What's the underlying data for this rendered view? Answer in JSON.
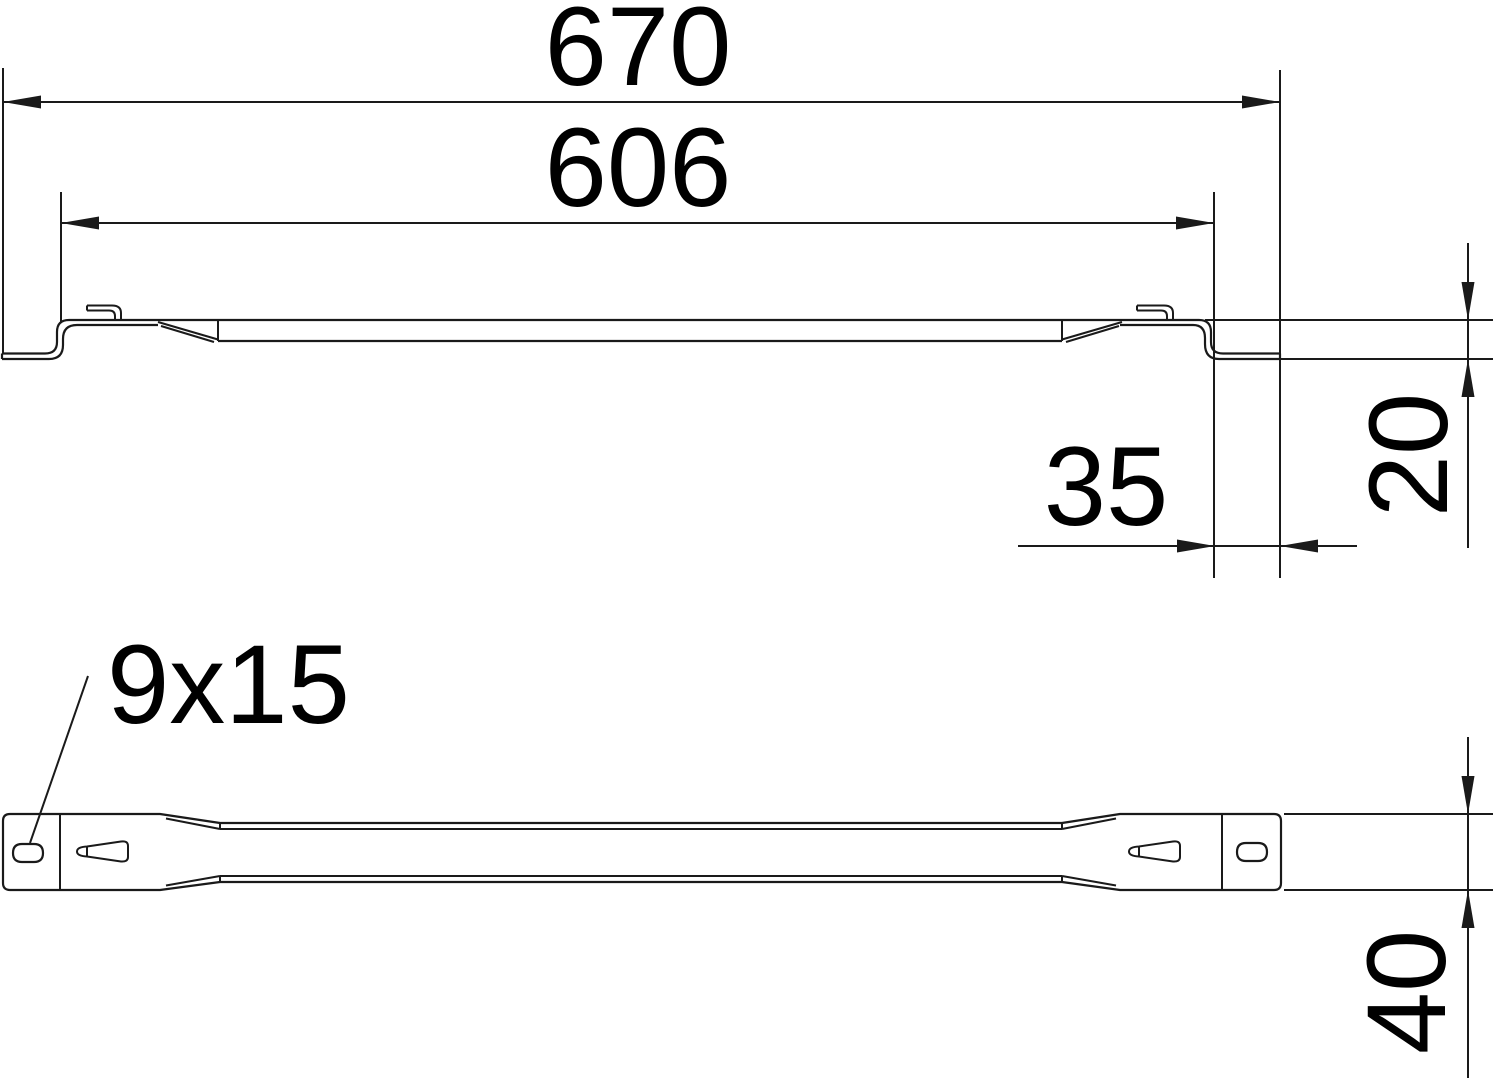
{
  "title": "Technical drawing - distance rail, side view and top view",
  "views": {
    "side_view": "side profile view",
    "top_view": "top (plan) view"
  },
  "dimensions": {
    "overall_length": "670",
    "inner_length": "606",
    "end_tab_length": "35",
    "end_offset_height": "20",
    "rail_width": "40",
    "slot_size": "9x15"
  },
  "colors": {
    "line": "#1a1a1a",
    "background": "#ffffff"
  }
}
